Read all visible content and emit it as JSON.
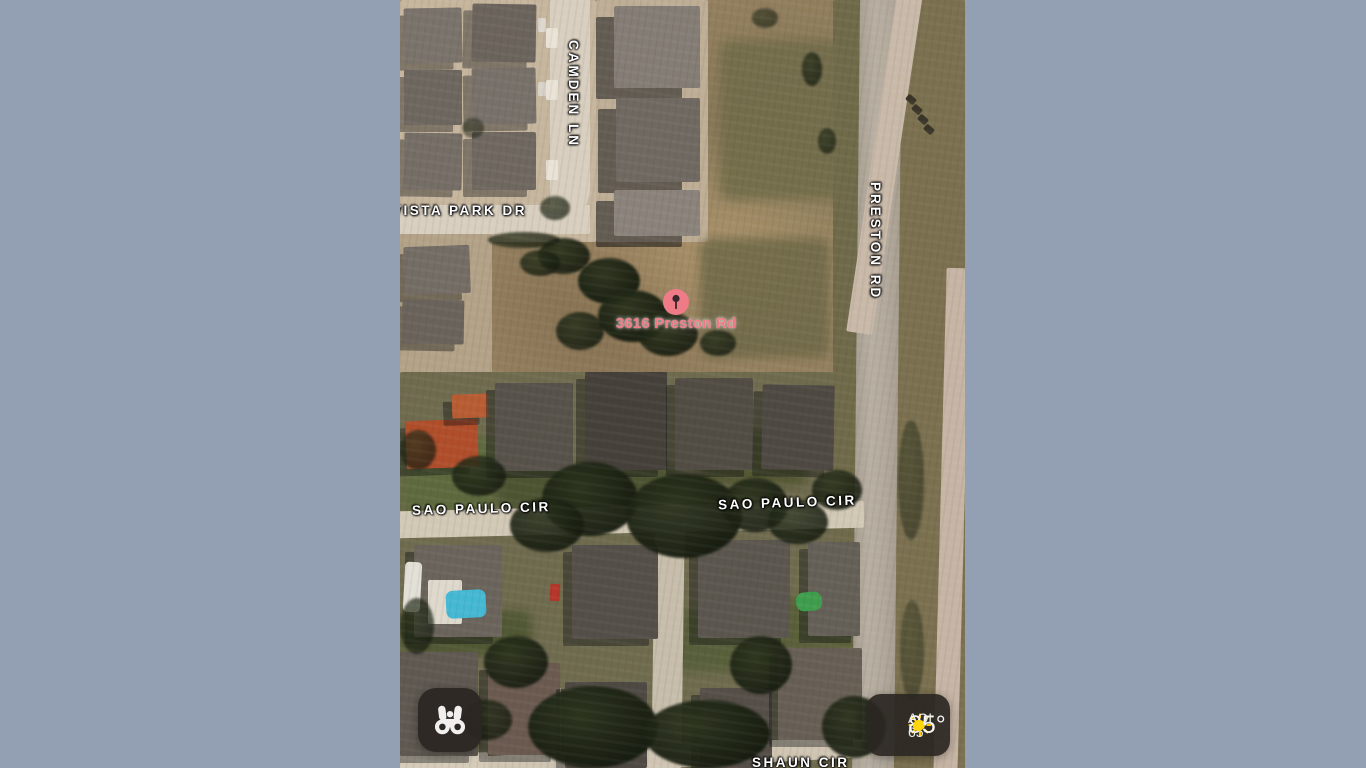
{
  "map": {
    "street_labels": [
      {
        "id": "camden-ln",
        "text": "CAMDEN LN"
      },
      {
        "id": "vista-park-dr",
        "text": "VISTA PARK DR"
      },
      {
        "id": "preston-rd",
        "text": "PRESTON RD"
      },
      {
        "id": "sao-paulo-cir-west",
        "text": "SAO PAULO CIR"
      },
      {
        "id": "sao-paulo-cir-east",
        "text": "SAO PAULO CIR"
      },
      {
        "id": "shaun-cir",
        "text": "SHAUN CIR"
      }
    ],
    "pin": {
      "label": "3616 Preston Rd",
      "color": "#ee7b86"
    }
  },
  "controls": {
    "look_around_button": {
      "icon": "binoculars-icon"
    },
    "weather_widget": {
      "temperature": "85°",
      "aqi": "AQI 65",
      "sun_color": "#ffcc02",
      "aqi_dot_color": "#ffd60a"
    }
  },
  "colors": {
    "letterbox": "#93a0b4"
  }
}
